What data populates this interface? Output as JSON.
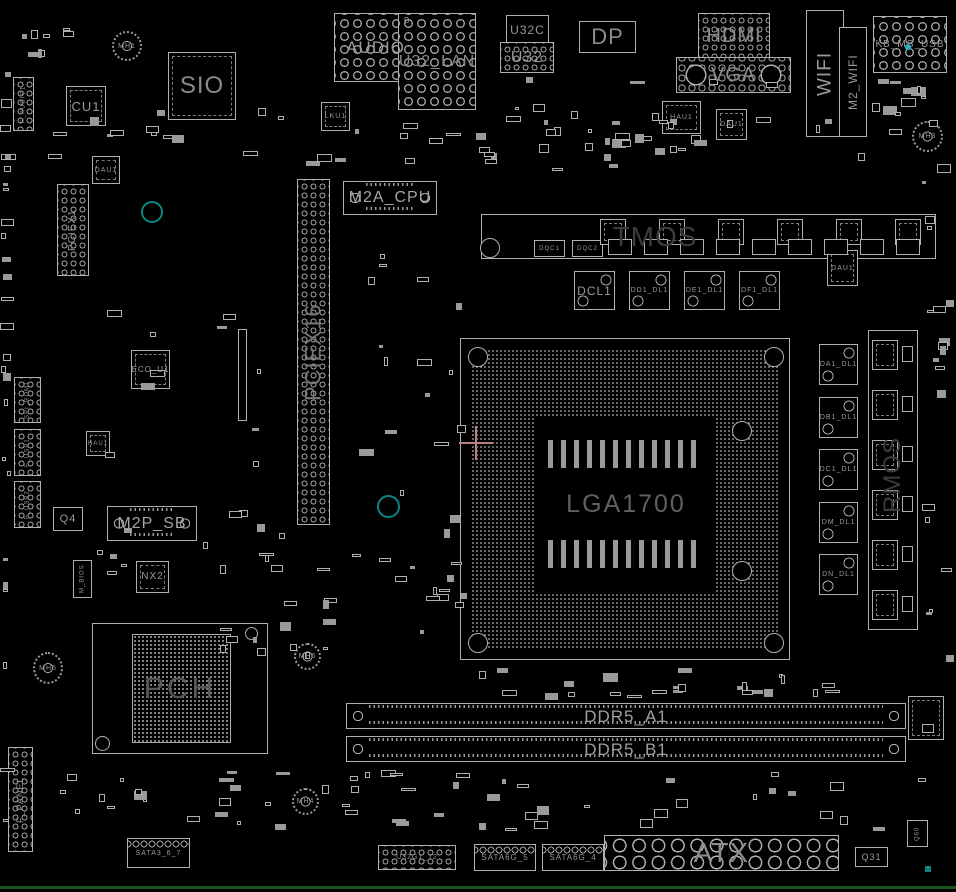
{
  "colors": {
    "bg": "#000000",
    "outline": "#b0b0b0",
    "label": "#9a9a9a",
    "ghost": "#3c3c3c",
    "teal": "#0d8383",
    "cyan": "#18b7c9",
    "crosshair": "#bb7f7f",
    "edge": "#17561d"
  },
  "socket": {
    "label": "LGA1700"
  },
  "pch": {
    "label": "PCH"
  },
  "components": [
    {
      "name": "chip-cu1",
      "label": "CU1",
      "x": 66,
      "y": 86,
      "w": 40,
      "h": 40,
      "type": "qfp",
      "fs": 13
    },
    {
      "name": "chip-sio",
      "label": "SIO",
      "x": 168,
      "y": 52,
      "w": 68,
      "h": 68,
      "type": "qfp",
      "fs": 24,
      "color": "#8a8a8a"
    },
    {
      "name": "mount-hole-mh1",
      "label": "MH1",
      "x": 112,
      "y": 31,
      "w": 30,
      "h": 30,
      "type": "mh",
      "fs": 7
    },
    {
      "name": "conn-f-audio",
      "label": "F_AUDIO1",
      "x": 13,
      "y": 77,
      "w": 21,
      "h": 54,
      "type": "holes holes-sm",
      "fs": 6,
      "vert": true
    },
    {
      "name": "chip-dau1-a",
      "label": "DAU1",
      "x": 92,
      "y": 156,
      "w": 28,
      "h": 28,
      "type": "qfp",
      "fs": 7
    },
    {
      "name": "slot-pciex1",
      "label": "PCIEX1",
      "x": 57,
      "y": 184,
      "w": 32,
      "h": 92,
      "type": "holes holes-sm",
      "fs": 10,
      "vert": true
    },
    {
      "name": "via-ring-a",
      "x": 141,
      "y": 201,
      "w": 22,
      "h": 22,
      "type": "ring",
      "interactable": false
    },
    {
      "name": "conn-spi-rom",
      "label": "SPI_ROM1",
      "x": 14,
      "y": 377,
      "w": 27,
      "h": 46,
      "type": "holes holes-sm",
      "fs": 6,
      "vert": true
    },
    {
      "name": "conn-f-usb1",
      "label": "F_USB1",
      "x": 14,
      "y": 429,
      "w": 27,
      "h": 47,
      "type": "holes holes-sm",
      "fs": 6,
      "vert": true
    },
    {
      "name": "conn-f-usb2",
      "label": "F_USB2",
      "x": 14,
      "y": 481,
      "w": 27,
      "h": 47,
      "type": "holes holes-sm",
      "fs": 6,
      "vert": true
    },
    {
      "name": "chip-eco-u1",
      "label": "ECO_U1",
      "x": 131,
      "y": 350,
      "w": 39,
      "h": 39,
      "type": "qfp",
      "fs": 8
    },
    {
      "name": "chip-hau1-b",
      "label": "HAU1",
      "x": 86,
      "y": 431,
      "w": 24,
      "h": 25,
      "type": "qfp",
      "fs": 6
    },
    {
      "name": "part-q4",
      "label": "Q4",
      "x": 53,
      "y": 507,
      "w": 30,
      "h": 24,
      "type": "box",
      "fs": 11
    },
    {
      "name": "slot-m2p-sb",
      "label": "M2P_SB",
      "x": 107,
      "y": 506,
      "w": 90,
      "h": 35,
      "type": "dimm",
      "fs": 16,
      "color": "#a5a5a5"
    },
    {
      "name": "part-nx2",
      "label": "NX2",
      "x": 136,
      "y": 561,
      "w": 33,
      "h": 32,
      "type": "qfp",
      "fs": 10
    },
    {
      "name": "chip-m-bios",
      "label": "M_BIOS",
      "x": 73,
      "y": 560,
      "w": 19,
      "h": 38,
      "type": "box",
      "fs": 6,
      "vert": true
    },
    {
      "name": "via-ring-b",
      "x": 377,
      "y": 495,
      "w": 23,
      "h": 23,
      "type": "ring",
      "interactable": false
    },
    {
      "name": "slot-pciex16",
      "label": "PCIEX16",
      "x": 297,
      "y": 179,
      "w": 33,
      "h": 346,
      "type": "holes holes-sm",
      "fs": 22,
      "vert": true,
      "color": "#787878"
    },
    {
      "name": "slot-thin",
      "x": 238,
      "y": 329,
      "w": 9,
      "h": 92,
      "type": "box",
      "interactable": false
    },
    {
      "name": "conn-audio",
      "label": "AUDIO",
      "x": 334,
      "y": 13,
      "w": 83,
      "h": 69,
      "type": "holes holes-md",
      "fs": 17,
      "color": "#9a9a9a"
    },
    {
      "name": "conn-u32-lan",
      "label": "U32_LAN",
      "x": 398,
      "y": 13,
      "w": 78,
      "h": 97,
      "type": "holes holes-md",
      "fs": 16,
      "color": "#8a8a8a"
    },
    {
      "name": "label-b",
      "label": "B",
      "x": 402,
      "y": 16,
      "w": 10,
      "h": 10,
      "type": "ghost",
      "fs": 8,
      "interactable": false
    },
    {
      "name": "conn-u32c",
      "label": "U32C",
      "x": 506,
      "y": 15,
      "w": 43,
      "h": 29,
      "type": "box",
      "fs": 12
    },
    {
      "name": "conn-u32",
      "label": "U32",
      "x": 500,
      "y": 42,
      "w": 54,
      "h": 31,
      "type": "holes holes-sm",
      "fs": 16
    },
    {
      "name": "conn-dp",
      "label": "DP",
      "x": 579,
      "y": 21,
      "w": 57,
      "h": 32,
      "type": "box",
      "fs": 22,
      "color": "#8a8a8a"
    },
    {
      "name": "chip-lku1",
      "label": "LKU1",
      "x": 321,
      "y": 102,
      "w": 29,
      "h": 29,
      "type": "qfp",
      "fs": 7
    },
    {
      "name": "conn-hdmi",
      "label": "HDMI",
      "x": 698,
      "y": 13,
      "w": 72,
      "h": 45,
      "type": "holes holes-sm",
      "fs": 20,
      "color": "#8a8a8a"
    },
    {
      "name": "conn-vga",
      "label": "VGA",
      "x": 676,
      "y": 57,
      "w": 115,
      "h": 36,
      "type": "vga",
      "fs": 20,
      "color": "#8a8a8a"
    },
    {
      "name": "conn-wifi",
      "label": "WIFI",
      "x": 806,
      "y": 10,
      "w": 38,
      "h": 127,
      "type": "box",
      "fs": 19,
      "vert": true,
      "color": "#9a9a9a"
    },
    {
      "name": "slot-m2-wifi",
      "label": "M2_WIFI",
      "x": 839,
      "y": 27,
      "w": 28,
      "h": 110,
      "type": "box",
      "fs": 12,
      "vert": true
    },
    {
      "name": "conn-kb-ms-usb",
      "label": "KB_MS_USB",
      "x": 873,
      "y": 16,
      "w": 74,
      "h": 57,
      "type": "holes holes-md",
      "fs": 10
    },
    {
      "name": "via-dot-cyan",
      "x": 905,
      "y": 44,
      "w": 6,
      "h": 6,
      "type": "dotc",
      "interactable": false
    },
    {
      "name": "mount-hole-mh3",
      "label": "MH3",
      "x": 912,
      "y": 121,
      "w": 31,
      "h": 31,
      "type": "mh",
      "fs": 7
    },
    {
      "name": "chip-hau1-a",
      "label": "HAU1",
      "x": 662,
      "y": 101,
      "w": 39,
      "h": 33,
      "type": "qfp",
      "fs": 7
    },
    {
      "name": "chip-dau1-b",
      "label": "DAU1",
      "x": 716,
      "y": 109,
      "w": 31,
      "h": 31,
      "type": "qfp",
      "fs": 7
    },
    {
      "name": "via-dot-a",
      "x": 66,
      "y": 30,
      "w": 7,
      "h": 7,
      "type": "ring",
      "interactable": false
    },
    {
      "name": "slot-m2a-cpu",
      "label": "M2A_CPU",
      "x": 343,
      "y": 181,
      "w": 94,
      "h": 34,
      "type": "dimm",
      "fs": 16,
      "color": "#a5a5a5"
    },
    {
      "name": "vrm-top-region",
      "x": 481,
      "y": 214,
      "w": 455,
      "h": 45,
      "type": "box",
      "interactable": false
    },
    {
      "name": "vrm-top-label",
      "label": "TMOS",
      "x": 595,
      "y": 216,
      "w": 120,
      "h": 42,
      "type": "ghost",
      "fs": 28,
      "color": "#3c3c3c",
      "interactable": false
    },
    {
      "name": "vrm-screw-hole",
      "x": 480,
      "y": 238,
      "w": 20,
      "h": 20,
      "type": "wring",
      "interactable": false
    },
    {
      "name": "chip-dqc1",
      "label": "DQC1",
      "x": 534,
      "y": 240,
      "w": 31,
      "h": 17,
      "type": "box",
      "fs": 6
    },
    {
      "name": "chip-dqc2",
      "label": "DQC2",
      "x": 572,
      "y": 240,
      "w": 31,
      "h": 17,
      "type": "box",
      "fs": 6
    },
    {
      "name": "ind-dcl1",
      "label": "DCL1",
      "x": 574,
      "y": 271,
      "w": 41,
      "h": 39,
      "type": "ind",
      "fs": 12
    },
    {
      "name": "ind-dd1-dl1",
      "label": "DD1_DL1",
      "x": 629,
      "y": 271,
      "w": 41,
      "h": 39,
      "type": "ind",
      "fs": 7
    },
    {
      "name": "ind-de1-dl1",
      "label": "DE1_DL1",
      "x": 684,
      "y": 271,
      "w": 41,
      "h": 39,
      "type": "ind",
      "fs": 7
    },
    {
      "name": "ind-df1-dl1",
      "label": "DF1_DL1",
      "x": 739,
      "y": 271,
      "w": 41,
      "h": 39,
      "type": "ind",
      "fs": 7
    },
    {
      "name": "chip-dau1-c",
      "label": "DAU1",
      "x": 827,
      "y": 250,
      "w": 31,
      "h": 36,
      "type": "qfp",
      "fs": 7
    },
    {
      "name": "ind-da1-dl1",
      "label": "DA1_DL1",
      "x": 819,
      "y": 344,
      "w": 39,
      "h": 41,
      "type": "ind",
      "fs": 7
    },
    {
      "name": "ind-db1-dl1",
      "label": "DB1_DL1",
      "x": 819,
      "y": 397,
      "w": 39,
      "h": 41,
      "type": "ind",
      "fs": 7
    },
    {
      "name": "ind-dc1-dl1",
      "label": "DC1_DL1",
      "x": 819,
      "y": 449,
      "w": 39,
      "h": 41,
      "type": "ind",
      "fs": 7
    },
    {
      "name": "ind-dm-dl1",
      "label": "DM_DL1",
      "x": 819,
      "y": 502,
      "w": 39,
      "h": 41,
      "type": "ind",
      "fs": 7
    },
    {
      "name": "ind-dn-dl1",
      "label": "DN_DL1",
      "x": 819,
      "y": 554,
      "w": 39,
      "h": 41,
      "type": "ind",
      "fs": 7
    },
    {
      "name": "vrm-right-region",
      "x": 868,
      "y": 330,
      "w": 50,
      "h": 300,
      "type": "box",
      "interactable": false
    },
    {
      "name": "vrm-right-label",
      "label": "RMOS",
      "x": 872,
      "y": 420,
      "w": 42,
      "h": 110,
      "type": "ghost",
      "fs": 24,
      "vert": true,
      "color": "#3c3c3c",
      "interactable": false
    },
    {
      "name": "mount-hole-mh5",
      "label": "MH5",
      "x": 33,
      "y": 652,
      "w": 30,
      "h": 32,
      "type": "mh",
      "fs": 7
    },
    {
      "name": "mount-hole-mh6",
      "label": "MH6",
      "x": 294,
      "y": 643,
      "w": 27,
      "h": 27,
      "type": "mh",
      "fs": 7
    },
    {
      "name": "mount-hole-mh4",
      "label": "MH4",
      "x": 292,
      "y": 788,
      "w": 27,
      "h": 27,
      "type": "mh",
      "fs": 7
    },
    {
      "name": "slot-ddr5-a1",
      "label": "DDR5_A1",
      "x": 346,
      "y": 703,
      "w": 560,
      "h": 26,
      "type": "dimm",
      "fs": 17,
      "color": "#9f9f9f"
    },
    {
      "name": "slot-ddr5-b1",
      "label": "DDR5_B1",
      "x": 346,
      "y": 736,
      "w": 560,
      "h": 26,
      "type": "dimm",
      "fs": 17,
      "color": "#9f9f9f"
    },
    {
      "name": "part-dimm-right",
      "x": 908,
      "y": 696,
      "w": 36,
      "h": 44,
      "type": "qfp",
      "interactable": false
    },
    {
      "name": "conn-f-panel",
      "label": "F_PANEL",
      "x": 8,
      "y": 747,
      "w": 25,
      "h": 105,
      "type": "holes holes-sm",
      "fs": 9,
      "vert": true
    },
    {
      "name": "conn-sata3-6-7",
      "label": "SATA3_6_7",
      "x": 127,
      "y": 838,
      "w": 63,
      "h": 30,
      "type": "sata",
      "fs": 7
    },
    {
      "name": "conn-u32g1",
      "label": "U32G1_12",
      "x": 378,
      "y": 845,
      "w": 78,
      "h": 25,
      "type": "holes holes-sm",
      "fs": 7
    },
    {
      "name": "conn-sata6g-5",
      "label": "SATA6G_5",
      "x": 474,
      "y": 844,
      "w": 62,
      "h": 27,
      "type": "sata",
      "fs": 8
    },
    {
      "name": "conn-sata6g-4",
      "label": "SATA6G_4",
      "x": 542,
      "y": 844,
      "w": 62,
      "h": 27,
      "type": "sata",
      "fs": 8
    },
    {
      "name": "conn-atx",
      "label": "ATX",
      "x": 604,
      "y": 835,
      "w": 235,
      "h": 36,
      "type": "holes holes-lg",
      "fs": 28,
      "color": "#8d8d8d"
    },
    {
      "name": "part-q31",
      "label": "Q31",
      "x": 855,
      "y": 847,
      "w": 33,
      "h": 20,
      "type": "box",
      "fs": 9
    },
    {
      "name": "part-q60",
      "label": "Q60",
      "x": 907,
      "y": 820,
      "w": 21,
      "h": 27,
      "type": "box",
      "fs": 6,
      "vert": true
    },
    {
      "name": "teal-dot",
      "x": 925,
      "y": 866,
      "w": 6,
      "h": 6,
      "type": "tealsq",
      "interactable": false
    }
  ],
  "repeats": [
    {
      "name": "vrm-fet-top",
      "x": 600,
      "y": 219,
      "dx": 59,
      "nx": 6,
      "w": 26,
      "h": 26,
      "type": "qfp"
    },
    {
      "name": "vrm-fet-bottom",
      "x": 608,
      "y": 239,
      "dx": 36,
      "nx": 9,
      "w": 24,
      "h": 16,
      "type": "box"
    },
    {
      "name": "vrm-fet-right",
      "x": 872,
      "y": 340,
      "dy": 50,
      "ny": 6,
      "w": 26,
      "h": 30,
      "type": "qfp"
    },
    {
      "name": "vrm-driver-right",
      "x": 902,
      "y": 346,
      "dy": 50,
      "ny": 6,
      "w": 11,
      "h": 16,
      "type": "box"
    }
  ],
  "decor": {
    "seed": 12,
    "bands": [
      {
        "x": 4,
        "y": 22,
        "w": 70,
        "h": 45,
        "n": 8
      },
      {
        "x": 0,
        "y": 70,
        "w": 12,
        "h": 790,
        "n": 26
      },
      {
        "x": 30,
        "y": 108,
        "w": 926,
        "h": 64,
        "n": 42
      },
      {
        "x": 470,
        "y": 75,
        "w": 330,
        "h": 95,
        "n": 26
      },
      {
        "x": 868,
        "y": 75,
        "w": 84,
        "h": 50,
        "n": 10
      },
      {
        "x": 95,
        "y": 285,
        "w": 200,
        "h": 330,
        "n": 22
      },
      {
        "x": 340,
        "y": 250,
        "w": 130,
        "h": 370,
        "n": 22
      },
      {
        "x": 470,
        "y": 664,
        "w": 330,
        "h": 36,
        "n": 16
      },
      {
        "x": 30,
        "y": 770,
        "w": 900,
        "h": 62,
        "n": 55
      },
      {
        "x": 920,
        "y": 150,
        "w": 34,
        "h": 660,
        "n": 20
      },
      {
        "x": 250,
        "y": 540,
        "w": 90,
        "h": 140,
        "n": 8
      },
      {
        "x": 620,
        "y": 680,
        "w": 260,
        "h": 18,
        "n": 8
      },
      {
        "x": 200,
        "y": 600,
        "w": 130,
        "h": 60,
        "n": 8
      },
      {
        "x": 380,
        "y": 560,
        "w": 90,
        "h": 90,
        "n": 8
      }
    ]
  }
}
